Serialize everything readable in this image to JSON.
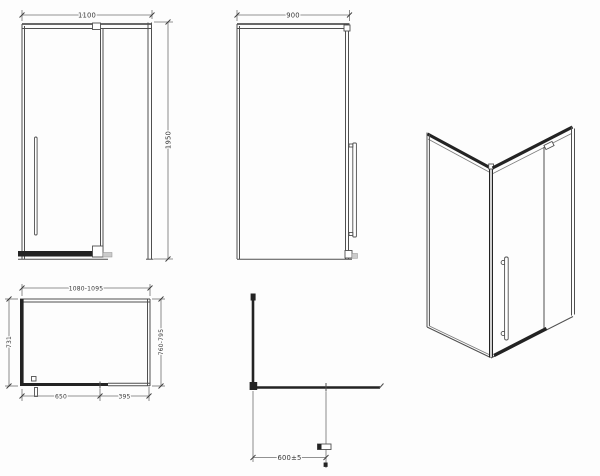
{
  "colors": {
    "background": "#fdfdfd",
    "line": "#4f4f4f",
    "profile": "#232323",
    "text": "#383838"
  },
  "drawing": {
    "front_view": {
      "width_label": "1100",
      "height_label": "1950"
    },
    "side_view": {
      "width_label": "900"
    },
    "plan_view": {
      "width_label": "1080-1095",
      "left_depth_label": "731",
      "right_depth_label": "760-795",
      "door_rail_label": "650",
      "fixed_panel_label": "395"
    },
    "corner_view": {
      "support_bar_label": "600±5"
    }
  }
}
